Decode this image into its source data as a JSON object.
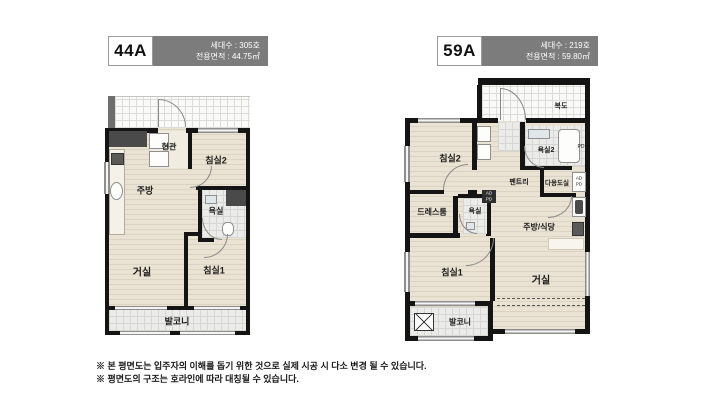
{
  "plan44": {
    "code": "44A",
    "units": "세대수 : 305호",
    "area": "전용면적 : 44.75㎡",
    "rooms": {
      "entrance": "현관",
      "bedroom2": "침실2",
      "kitchen": "주방",
      "bath": "욕실",
      "living": "거실",
      "bedroom1": "침실1",
      "balcony": "발코니"
    }
  },
  "plan59": {
    "code": "59A",
    "units": "세대수 : 219호",
    "area": "전용면적 : 59.80㎡",
    "rooms": {
      "corridor": "복도",
      "bedroom2": "침실2",
      "bath2": "욕실2",
      "pantry": "펜트리",
      "utility": "다용도실",
      "dressroom": "드레스룸",
      "bath": "욕실",
      "kitchen_dining": "주방/식당",
      "bedroom1": "침실1",
      "living": "거실",
      "balcony": "발코니",
      "ad": "AD",
      "pd": "PD"
    }
  },
  "footer": {
    "line1": "※ 본 평면도는 입주자의 이해를 돕기 위한 것으로 실제 시공 시 다소 변경 될 수 있습니다.",
    "line2": "※ 평면도의 구조는 호라인에 따라 대칭될 수 있습니다."
  },
  "colors": {
    "header_bg": "#7c7c7c",
    "wall": "#141414",
    "floor_wood": "#eae3d3",
    "tile": "#ebebe9",
    "duct_dark": "#4a4a4a",
    "window_gray": "#8e8e8e"
  }
}
